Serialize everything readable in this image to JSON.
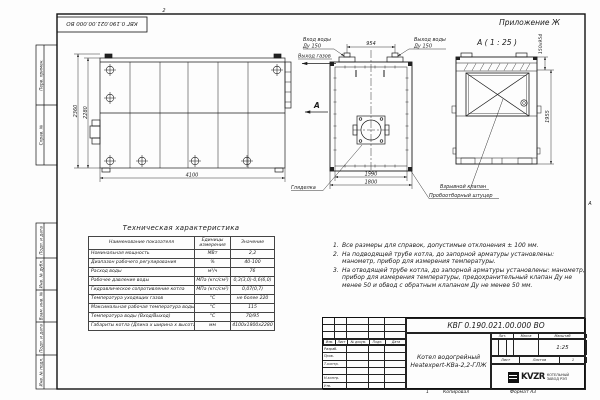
{
  "page": {
    "zone_top": "2",
    "zone_right": "А",
    "top_stamp": "КВГ 0.190.021.00.000 ВО",
    "appendix": "Приложение Ж"
  },
  "margin": {
    "labels": [
      "Перв. примен.",
      "Справ. №",
      "Подп. и дата",
      "Инв. № дубл.",
      "Взам. инв. №",
      "Подп. и дата",
      "Инв. № подл."
    ]
  },
  "side": {
    "dim_outer": "2360",
    "dim_inner": "2280",
    "dim_len": "4100"
  },
  "front": {
    "label_in1": "Вход воды",
    "label_in2": "Ду 150",
    "label_out1": "Выход воды",
    "label_out2": "Ду 150",
    "dim_pipes": "954",
    "label_gas": "Выход газов",
    "view_letter": "А",
    "dim_inner": "1590",
    "dim_outer": "1800",
    "label_peephole": "Гляделка",
    "label_sampling": "Пробоотборный штуцер"
  },
  "aview": {
    "title": "А ( 1 : 25 )",
    "dim_side": "150х954",
    "dim_height": "1955",
    "label_explosion": "Взрывной клапан"
  },
  "tech_table": {
    "title": "Техническая характеристика",
    "headers": [
      "Наименование показателя",
      "Единицы измерения",
      "Значение"
    ],
    "rows": [
      [
        "Номинальная мощность",
        "МВт",
        "2,2"
      ],
      [
        "Диапазон рабочего регулирования",
        "%",
        "40-100"
      ],
      [
        "Расход воды",
        "м³/ч",
        "76"
      ],
      [
        "Рабочее давление воды",
        "МПа (кгс/см²)",
        "0,3(3,0)-0,6(6,0)"
      ],
      [
        "Гидравлическое сопротивление котла",
        "МПа (кгс/см²)",
        "0,07(0,7)"
      ],
      [
        "Температура уходящих газов",
        "°С",
        "не более 220"
      ],
      [
        "Максимальная рабочая температура воды",
        "°С",
        "115"
      ],
      [
        "Температура воды (Вход/Выход)",
        "°С",
        "70/95"
      ],
      [
        "Габариты котла (Длина х ширина х высота)",
        "мм",
        "4100х1800х2280"
      ]
    ]
  },
  "notes": {
    "items": [
      {
        "num": "1.",
        "text": "Все размеры для справок, допустимые отклонения ± 100 мм."
      },
      {
        "num": "2.",
        "text": "На подводящей трубе котла, до запорной арматуры установлены: манометр, прибор для измерения температуры."
      },
      {
        "num": "3.",
        "text": "На отводящей трубе котла, до запорной арматуры установлены: манометр, прибор для измерения температуры, предохранительный клапан Ду не менее 50 и обвод с обратным клапаном Ду не менее 50 мм."
      }
    ]
  },
  "title_block": {
    "doc_number": "КВГ 0.190.021.00.000 ВО",
    "name_line1": "Котел водогрейный",
    "name_line2": "Heatexpert-КВа-2,2-ГЛЖ",
    "cols": {
      "izm": "Изм.",
      "list": "Лист",
      "dokum": "№ докум.",
      "podp": "Подп.",
      "data": "Дата"
    },
    "approvals": [
      "Разраб.",
      "Пров.",
      "Т.контр.",
      "",
      "Н.контр.",
      "Утв."
    ],
    "lit": "Лит.",
    "mass": "Масса",
    "scale_label": "Масштаб",
    "scale": "1:25",
    "sheet": "Лист",
    "sheets": "Листов",
    "sheets_num": "1",
    "company": {
      "abbr": "KVZR",
      "line1": "КОТЕЛЬНЫЙ",
      "line2": "ЗАВОД РЭП"
    }
  },
  "footer": {
    "num": "1",
    "copied": "Копировал",
    "format": "Формат А3"
  }
}
